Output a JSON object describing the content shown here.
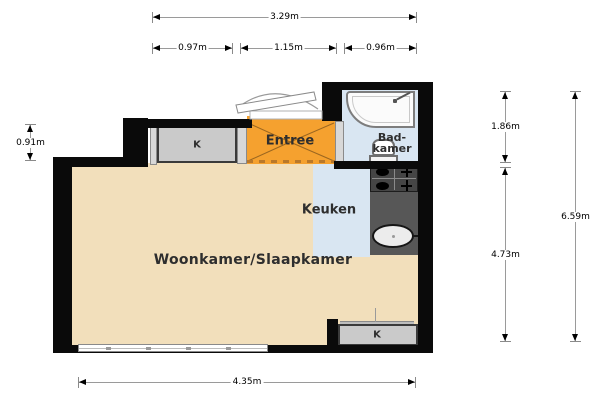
{
  "plan": {
    "rooms": {
      "woonkamer": {
        "label": "Woonkamer/Slaapkamer"
      },
      "keuken": {
        "label": "Keuken"
      },
      "entree": {
        "label": "Entree"
      },
      "badkamer": {
        "label": "Bad-kamer",
        "line1": "Bad-",
        "line2": "kamer"
      },
      "closet_top": {
        "label": "K"
      },
      "closet_bottom": {
        "label": "K"
      }
    },
    "dimensions": {
      "top_total": "3.29m",
      "top_left": "0.97m",
      "top_mid": "1.15m",
      "top_right": "0.96m",
      "left": "0.91m",
      "right_upper": "1.86m",
      "right_lower": "4.73m",
      "right_total": "6.59m",
      "bottom": "4.35m"
    },
    "colors": {
      "wall": "#0A0A0A",
      "floor_wood": "#F2DFBB",
      "floor_tile": "#D9E6F2",
      "entree_floor": "#F5A12F",
      "closet_fill": "#CACACA",
      "counter": "#575757"
    }
  }
}
